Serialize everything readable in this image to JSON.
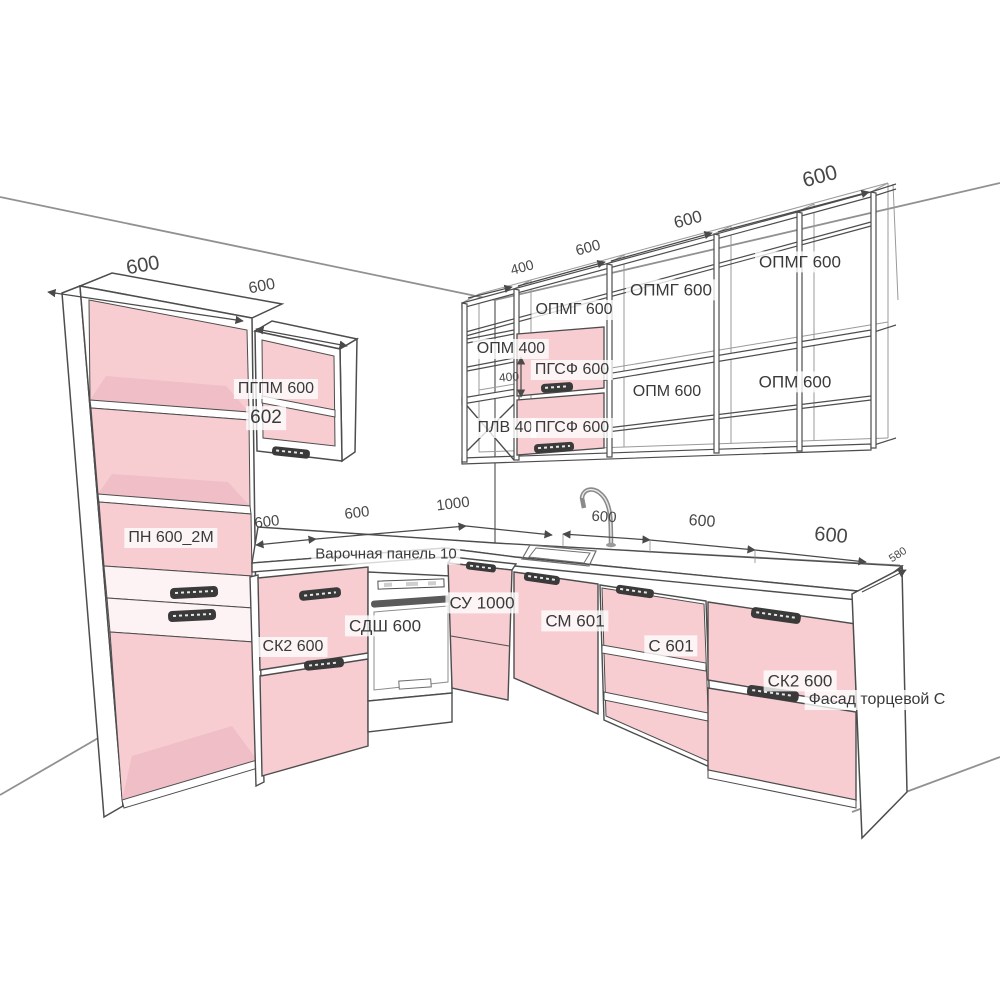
{
  "drawing": {
    "type": "3d-kitchen-layout-diagram",
    "language": "ru",
    "colors": {
      "cabinet_fill": "#f7cdd2",
      "cabinet_fill_shade": "#f0bec6",
      "outline": "#4d4d4d",
      "wall_line": "#919191",
      "label_text": "#3a3a3a",
      "label_bg": "rgba(255,255,255,0.78)",
      "handle": "#3a3a3a"
    }
  },
  "labels": {
    "modules": [
      {
        "id": "opmg-600-top-right",
        "text": "ОПМГ 600"
      },
      {
        "id": "opmg-600-top-mid",
        "text": "ОПМГ 600"
      },
      {
        "id": "opmg-600-top-left",
        "text": "ОПМГ 600"
      },
      {
        "id": "opm-400",
        "text": "ОПМ 400"
      },
      {
        "id": "pgsf-600-upper",
        "text": "ПГСФ 600"
      },
      {
        "id": "opm-600-right",
        "text": "ОПМ 600"
      },
      {
        "id": "opm-600-mid",
        "text": "ОПМ 600"
      },
      {
        "id": "plv-40",
        "text": "ПЛВ 40"
      },
      {
        "id": "pgsf-600-lower",
        "text": "ПГСФ 600"
      },
      {
        "id": "pgpm-600",
        "text": "ПГПМ 600"
      },
      {
        "id": "num-602",
        "text": "602"
      },
      {
        "id": "pn-600-2m",
        "text": "ПН 600_2М"
      },
      {
        "id": "hob-panel",
        "text": "Варочная панель 10"
      },
      {
        "id": "sdsh-600",
        "text": "СДШ 600"
      },
      {
        "id": "sk2-600-left",
        "text": "СК2 600"
      },
      {
        "id": "su-1000",
        "text": "СУ 1000"
      },
      {
        "id": "sm-601",
        "text": "СМ 601"
      },
      {
        "id": "s-601",
        "text": "С 601"
      },
      {
        "id": "sk2-600-right",
        "text": "СК2 600"
      },
      {
        "id": "fasad-tortsevoy-s",
        "text": "Фасад торцевой С"
      }
    ],
    "dimensions": [
      {
        "id": "tall-cabinet-width",
        "text": "600"
      },
      {
        "id": "pgpm-width",
        "text": "600"
      },
      {
        "id": "shelf-width-400",
        "text": "400"
      },
      {
        "id": "shelf-width-600-a",
        "text": "600"
      },
      {
        "id": "shelf-width-600-b",
        "text": "600"
      },
      {
        "id": "shelf-width-600-c",
        "text": "600"
      },
      {
        "id": "pgsf-height-400",
        "text": "400"
      },
      {
        "id": "base-left-600-a",
        "text": "600"
      },
      {
        "id": "base-left-600-b",
        "text": "600"
      },
      {
        "id": "base-left-1000",
        "text": "1000"
      },
      {
        "id": "sink-width-600",
        "text": "600"
      },
      {
        "id": "base-right-600-a",
        "text": "600"
      },
      {
        "id": "base-right-600-b",
        "text": "600"
      },
      {
        "id": "counter-depth-580",
        "text": "580"
      }
    ]
  }
}
